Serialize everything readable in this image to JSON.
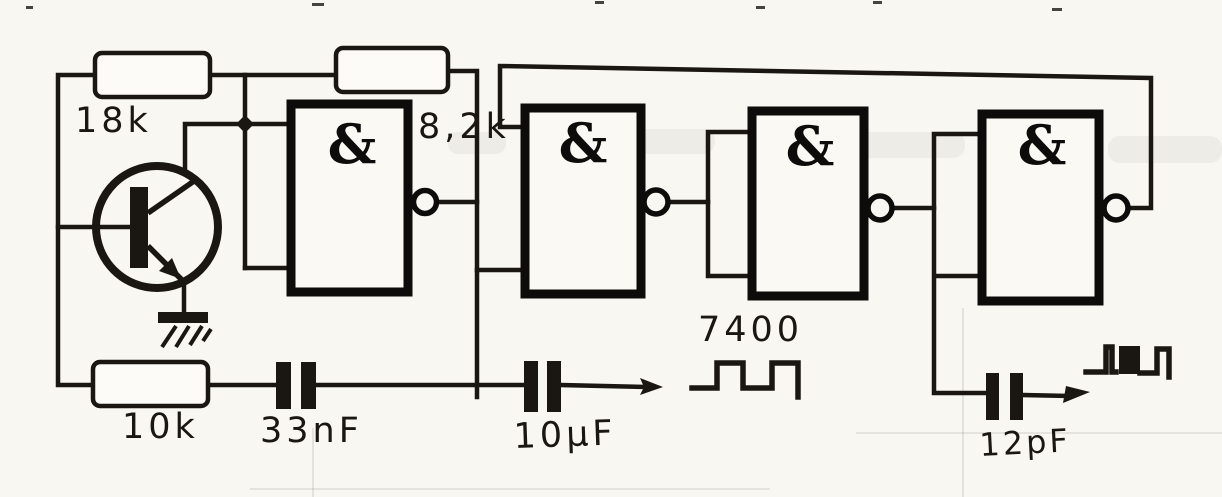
{
  "diagram": {
    "gates": [
      {
        "symbol": "&"
      },
      {
        "symbol": "&"
      },
      {
        "symbol": "&"
      },
      {
        "symbol": "&"
      }
    ],
    "labels": {
      "r1": "18k",
      "r2": "8,2k",
      "r3": "10k",
      "c1": "33nF",
      "c2": "10µF",
      "c3": "12pF",
      "ic": "7400"
    },
    "symbols": [
      "npn-transistor",
      "ground",
      "junction-dot",
      "inverter-bubble",
      "square-wave",
      "burst-wave",
      "arrow-right"
    ]
  },
  "colors": {
    "ink": "#1a1713",
    "paper": "#f8f7f2",
    "gate_border": "#0d0c0a"
  }
}
